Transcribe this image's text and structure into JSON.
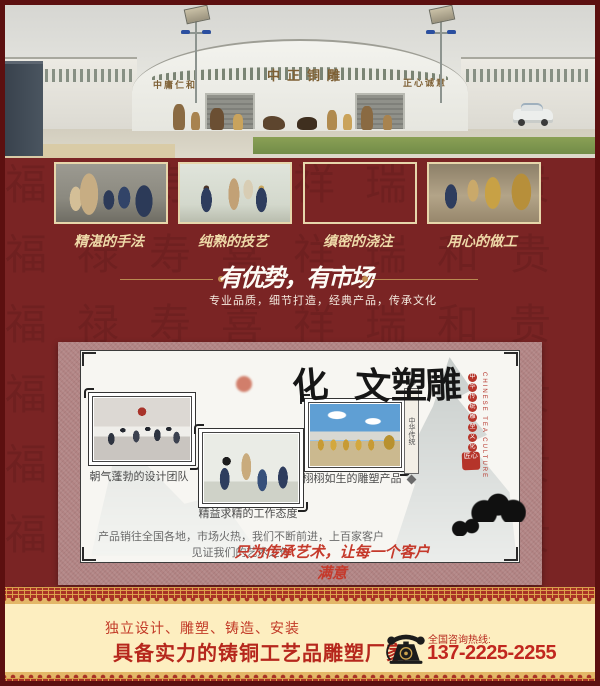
{
  "hero": {
    "sign_left": "中庸仁和",
    "sign_center": "中正铜雕",
    "sign_right": "正心诚意"
  },
  "process": {
    "captions": [
      "精湛的手法",
      "纯熟的技艺",
      "缜密的浇注",
      "用心的做工"
    ]
  },
  "advantage": {
    "title": "有优势，有市场",
    "subtitle": "专业品质，细节打造，经典产品，传承文化"
  },
  "culture": {
    "vertical_title": "雕塑文化",
    "side_dots": "中华传统雕塑文化",
    "side_en": "CHINESE TEA CULTURE",
    "plaque": "中华传统",
    "seal": "匠心",
    "captions": [
      "朝气蓬勃的设计团队",
      "精益求精的工作态度",
      "栩栩如生的雕塑产品"
    ],
    "summary": "产品销往全国各地，市场火热，我们不断前进，上百家客户见证我们的艺术之作",
    "slogan": "只为传承艺术，让每一个客户满意"
  },
  "footer": {
    "line1": "独立设计、雕塑、铸造、安装",
    "line2": "具备实力的铸铜工艺品雕塑厂家",
    "hotline_label": "全国咨询热线:",
    "phone": "137-2225-2255"
  },
  "colors": {
    "page_bg": "#7a2424",
    "page_border": "#5c1010",
    "gold_accent": "#c08b4e",
    "matte_pink": "#b28484",
    "footer_cream": "#fdeec0",
    "footer_red": "#b6271c",
    "seal_red": "#b5342a"
  },
  "decor": {
    "pattern_chars": "福禄寿喜祥瑞和贵"
  }
}
